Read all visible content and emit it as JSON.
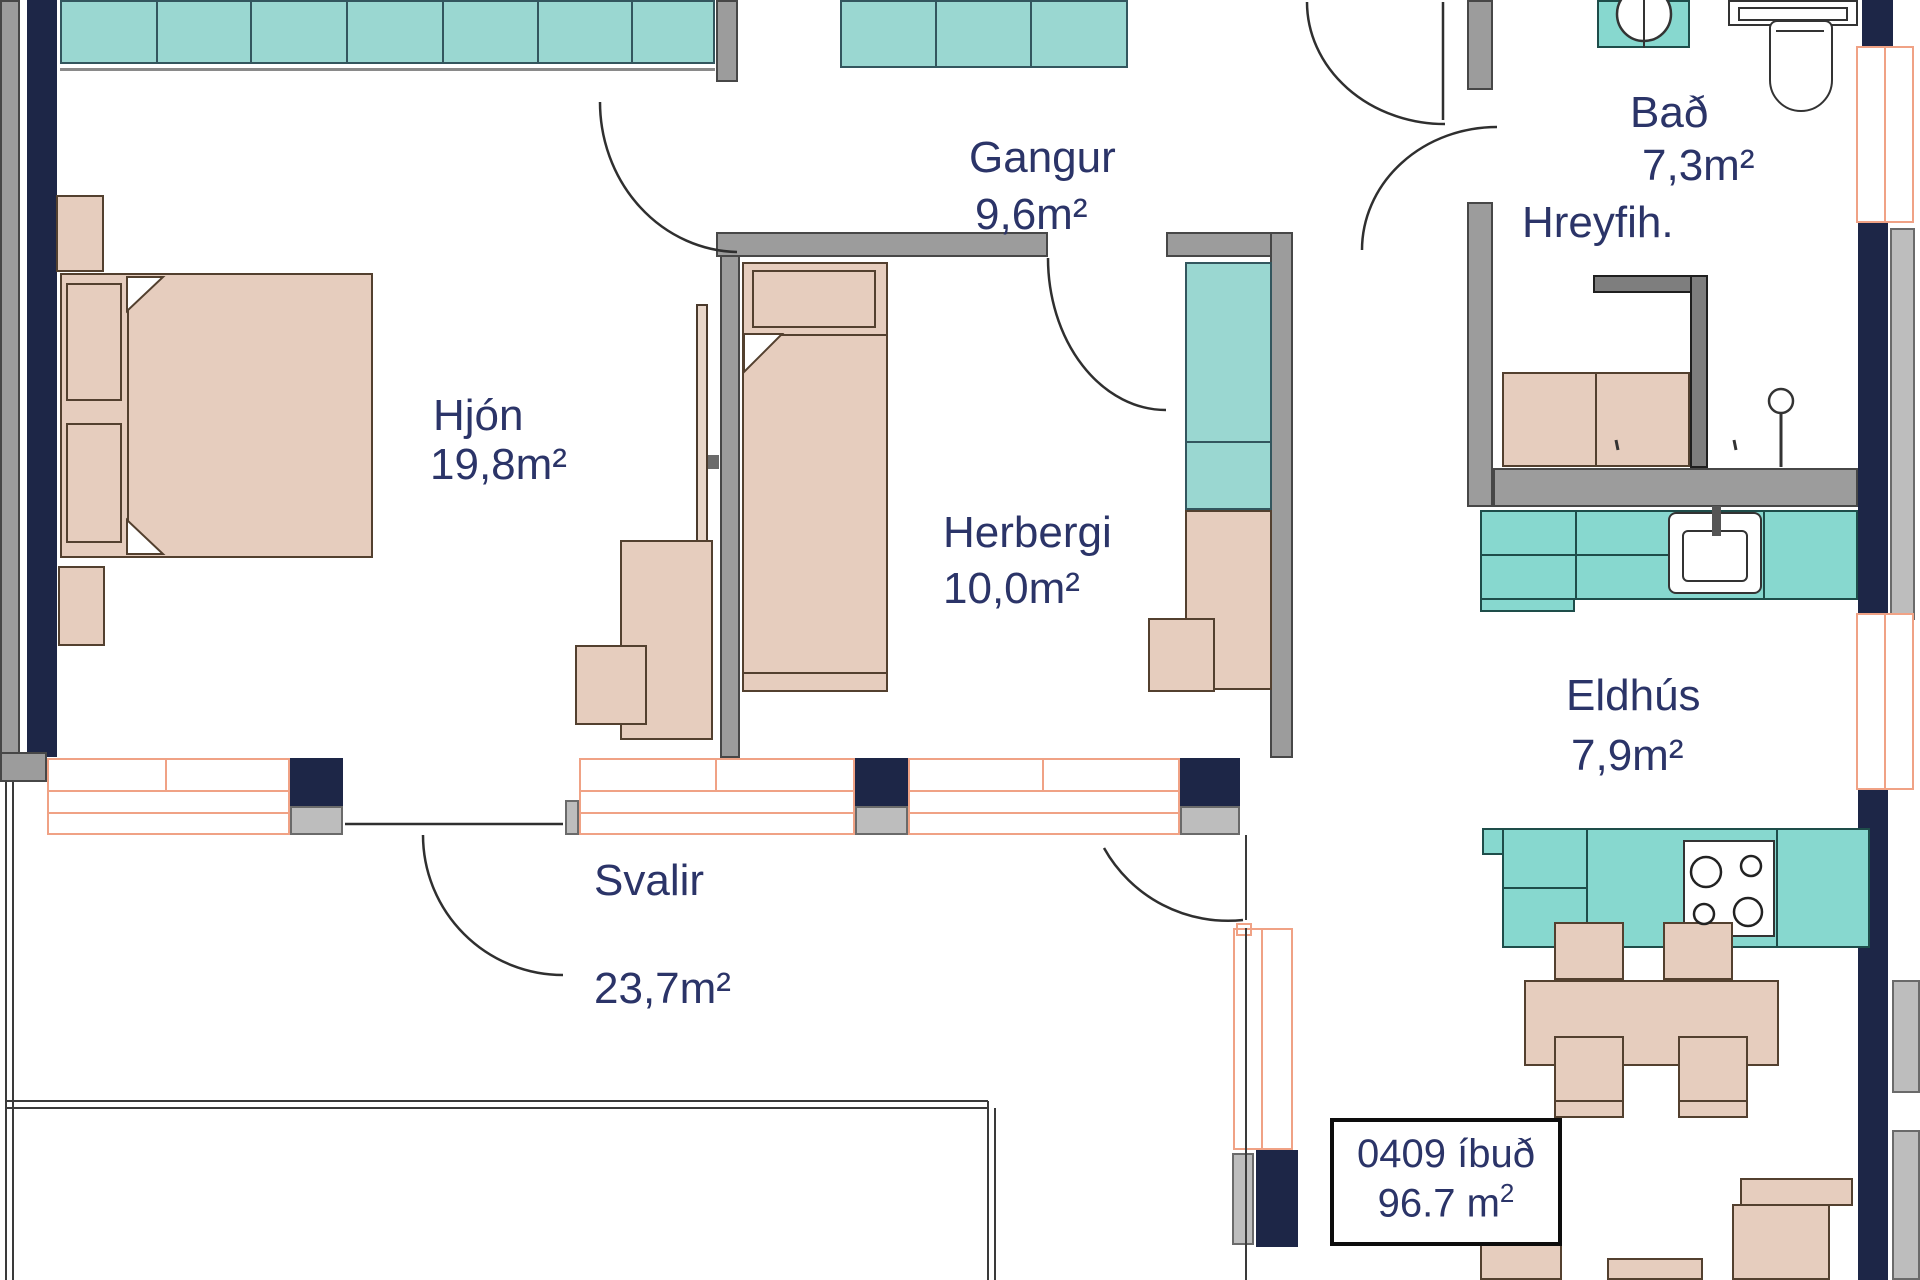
{
  "document": {
    "type": "apartment floor plan",
    "language": "Icelandic"
  },
  "rooms": {
    "hjon": {
      "name": "Hjón",
      "area": "19,8m²"
    },
    "gangur": {
      "name": "Gangur",
      "area": "9,6m²"
    },
    "herbergi": {
      "name": "Herbergi",
      "area": "10,0m²"
    },
    "bad": {
      "name": "Bað",
      "area": "7,3m²"
    },
    "eldhus": {
      "name": "Eldhús",
      "area": "7,9m²"
    },
    "svalir": {
      "name": "Svalir",
      "area": "23,7m²"
    }
  },
  "bathroom_accessibility_note": "Hreyfih.",
  "unit_label": {
    "id_line": "0409 íbuð",
    "area_value": "96.7",
    "area_unit_base": "m",
    "area_unit_exponent": "2"
  },
  "colors": {
    "wardrobe_teal": "#9ad7d1",
    "counter_teal": "#87d8cf",
    "furniture_beige": "#e6cdbe",
    "wall_navy": "#1d2647",
    "wall_gray": "#9c9c9c",
    "window_orange": "#f0a285",
    "label_text": "#2b3468"
  }
}
